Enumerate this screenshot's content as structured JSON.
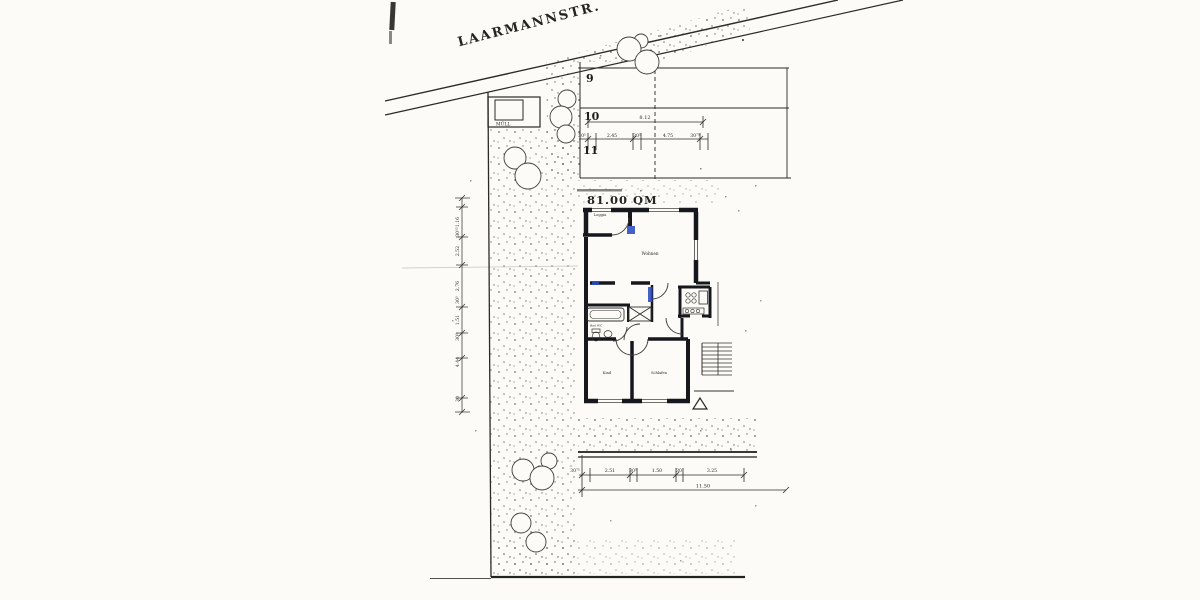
{
  "street": {
    "name": "LAARMANNSTR."
  },
  "site": {
    "muell_label": "MÜLL",
    "area_label": "81.00 QM",
    "plot_numbers": {
      "p9": "9",
      "p10": "10",
      "p11": "11"
    }
  },
  "rooms": {
    "loggia": "Loggia",
    "wohnen": "Wohnen",
    "bad": "Bad WC",
    "kind": "Kind",
    "schlafen": "Schlafen"
  },
  "dimensions": {
    "top": {
      "total": "8.12",
      "segments": [
        "30⁵",
        "2.45",
        "30⁵",
        "4.75",
        "30⁷⁵"
      ]
    },
    "left": {
      "segments": [
        "1.16",
        "30¹⁵",
        "2.52",
        "2.76",
        "30⁵",
        "1.51",
        "30⁵",
        "4.44",
        "30"
      ]
    },
    "bottom": {
      "total": "11.50",
      "segments": [
        "30⁷⁵",
        "2.51",
        "30⁵",
        "1.50",
        "30",
        "3.25"
      ]
    }
  },
  "colors": {
    "ink": "#23241f",
    "wall": "#16181d",
    "marker_blue": "#2b4bbf",
    "paper": "#fcfbf8"
  }
}
